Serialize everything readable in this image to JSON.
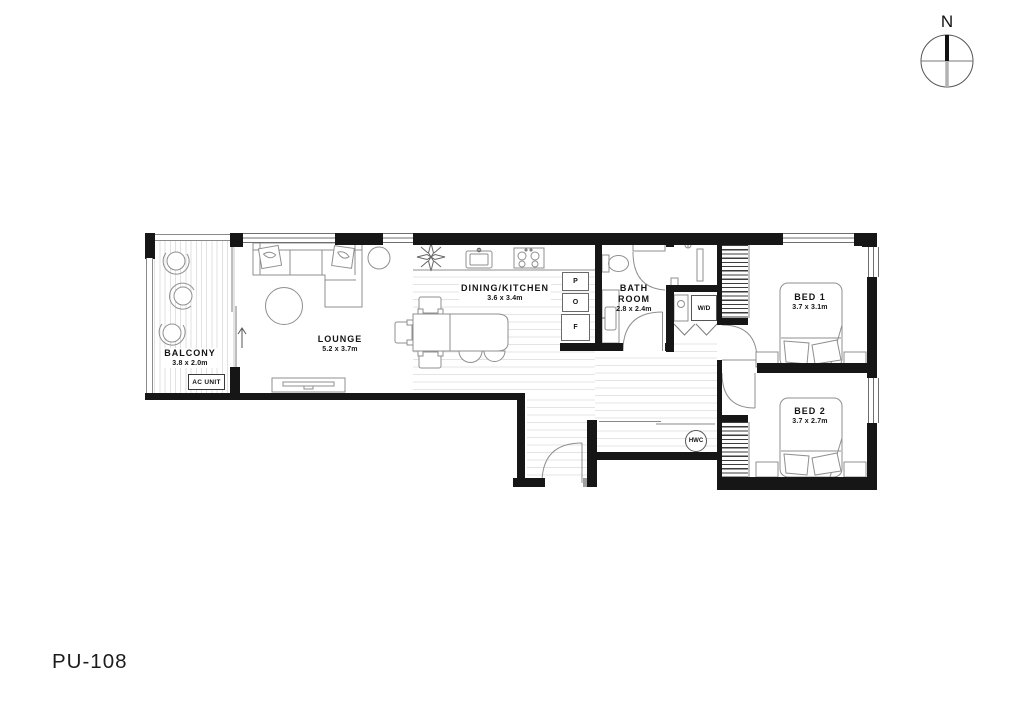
{
  "plan": {
    "unit_id": "PU-108",
    "compass_north": "N",
    "rooms": {
      "balcony": {
        "name": "BALCONY",
        "dims": "3.8 x 2.0m"
      },
      "lounge": {
        "name": "LOUNGE",
        "dims": "5.2 x 3.7m"
      },
      "dining_kitchen": {
        "name": "DINING/KITCHEN",
        "dims": "3.6 x 3.4m"
      },
      "bathroom": {
        "name_line1": "BATH",
        "name_line2": "ROOM",
        "dims": "2.8 x 2.4m"
      },
      "bed1": {
        "name": "BED 1",
        "dims": "3.7 x 3.1m"
      },
      "bed2": {
        "name": "BED 2",
        "dims": "3.7 x 2.7m"
      }
    },
    "fixtures": {
      "ac_unit": "AC UNIT",
      "washer_dryer": "W/D",
      "hot_water_cylinder": "HWC",
      "pantry": "P",
      "oven": "O",
      "fridge": "F"
    },
    "colors": {
      "wall": "#161616",
      "furniture_line": "#8f8f8f",
      "floor_line": "#e4e4e4"
    }
  }
}
